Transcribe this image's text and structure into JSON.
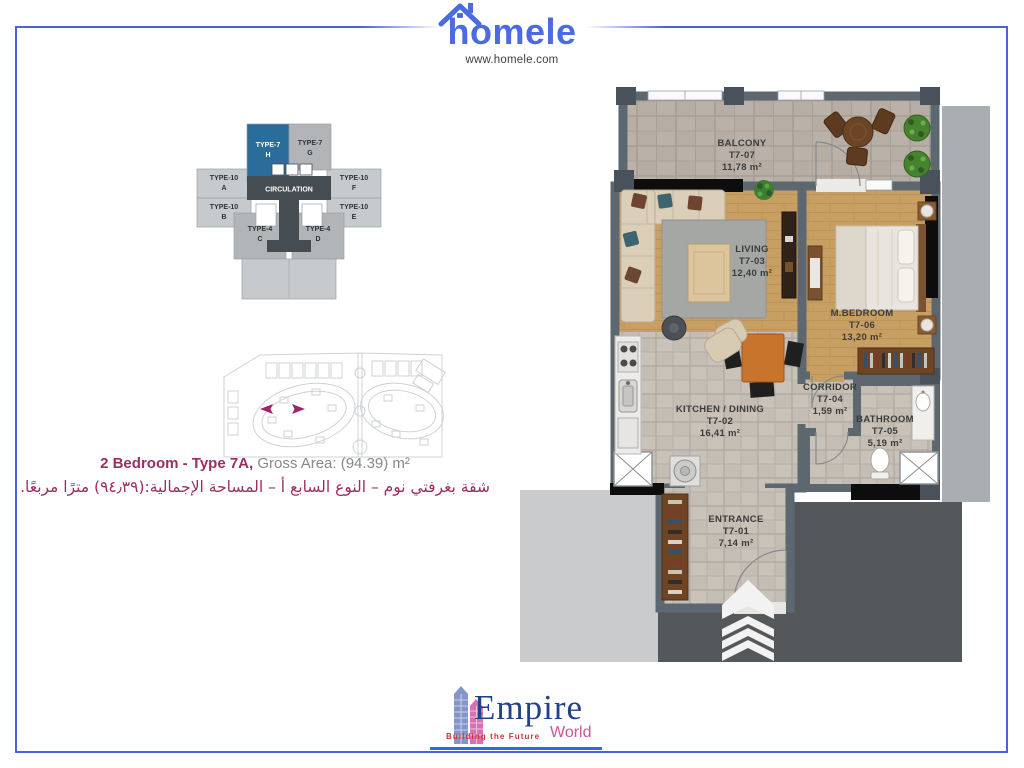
{
  "header": {
    "brand": "homele",
    "website": "www.homele.com"
  },
  "key_plan": {
    "circulation": "CIRCULATION",
    "units": [
      {
        "type": "TYPE-7",
        "letter": "H",
        "highlighted": true
      },
      {
        "type": "TYPE-7",
        "letter": "G",
        "highlighted": false
      },
      {
        "type": "TYPE-10",
        "letter": "A",
        "highlighted": false
      },
      {
        "type": "TYPE-10",
        "letter": "F",
        "highlighted": false
      },
      {
        "type": "TYPE-10",
        "letter": "B",
        "highlighted": false
      },
      {
        "type": "TYPE-10",
        "letter": "E",
        "highlighted": false
      },
      {
        "type": "TYPE-4",
        "letter": "C",
        "highlighted": false
      },
      {
        "type": "TYPE-4",
        "letter": "D",
        "highlighted": false
      }
    ]
  },
  "title": {
    "en_highlight": "2 Bedroom - Type 7A,",
    "en_rest": " Gross Area: (94.39) m²",
    "ar": "شقة بغرفتي نوم – النوع السابع أ – المساحة الإجمالية:(٩٤٫٣٩) مترًا مربعًا."
  },
  "floor_plan": {
    "rooms": [
      {
        "name": "ENTRANCE",
        "code": "T7-01",
        "area": "7,14 m²"
      },
      {
        "name": "KITCHEN / DINING",
        "code": "T7-02",
        "area": "16,41 m²"
      },
      {
        "name": "LIVING",
        "code": "T7-03",
        "area": "12,40 m²"
      },
      {
        "name": "CORRIDOR",
        "code": "T7-04",
        "area": "1,59 m²"
      },
      {
        "name": "BATHROOM",
        "code": "T7-05",
        "area": "5,19 m²"
      },
      {
        "name": "M.BEDROOM",
        "code": "T7-06",
        "area": "13,20 m²"
      },
      {
        "name": "BALCONY",
        "code": "T7-07",
        "area": "11,78 m²"
      }
    ]
  },
  "footer": {
    "brand": "Empire",
    "brand_secondary": "World",
    "tagline": "Building the Future"
  },
  "colors": {
    "accent_blue": "#4a63dd",
    "brand_blue": "#4a6be2",
    "brand_magenta": "#9b2e63",
    "keyplan_highlight_blue": "#2a6d9b",
    "wall_gray": "#5d6770",
    "wood_floor": "#c89f63",
    "tile_floor": "#c4bdb4",
    "window_black": "#0d0d0d",
    "empire_navy": "#21418c",
    "empire_pink": "#d0549d",
    "empire_red": "#cc3333"
  }
}
